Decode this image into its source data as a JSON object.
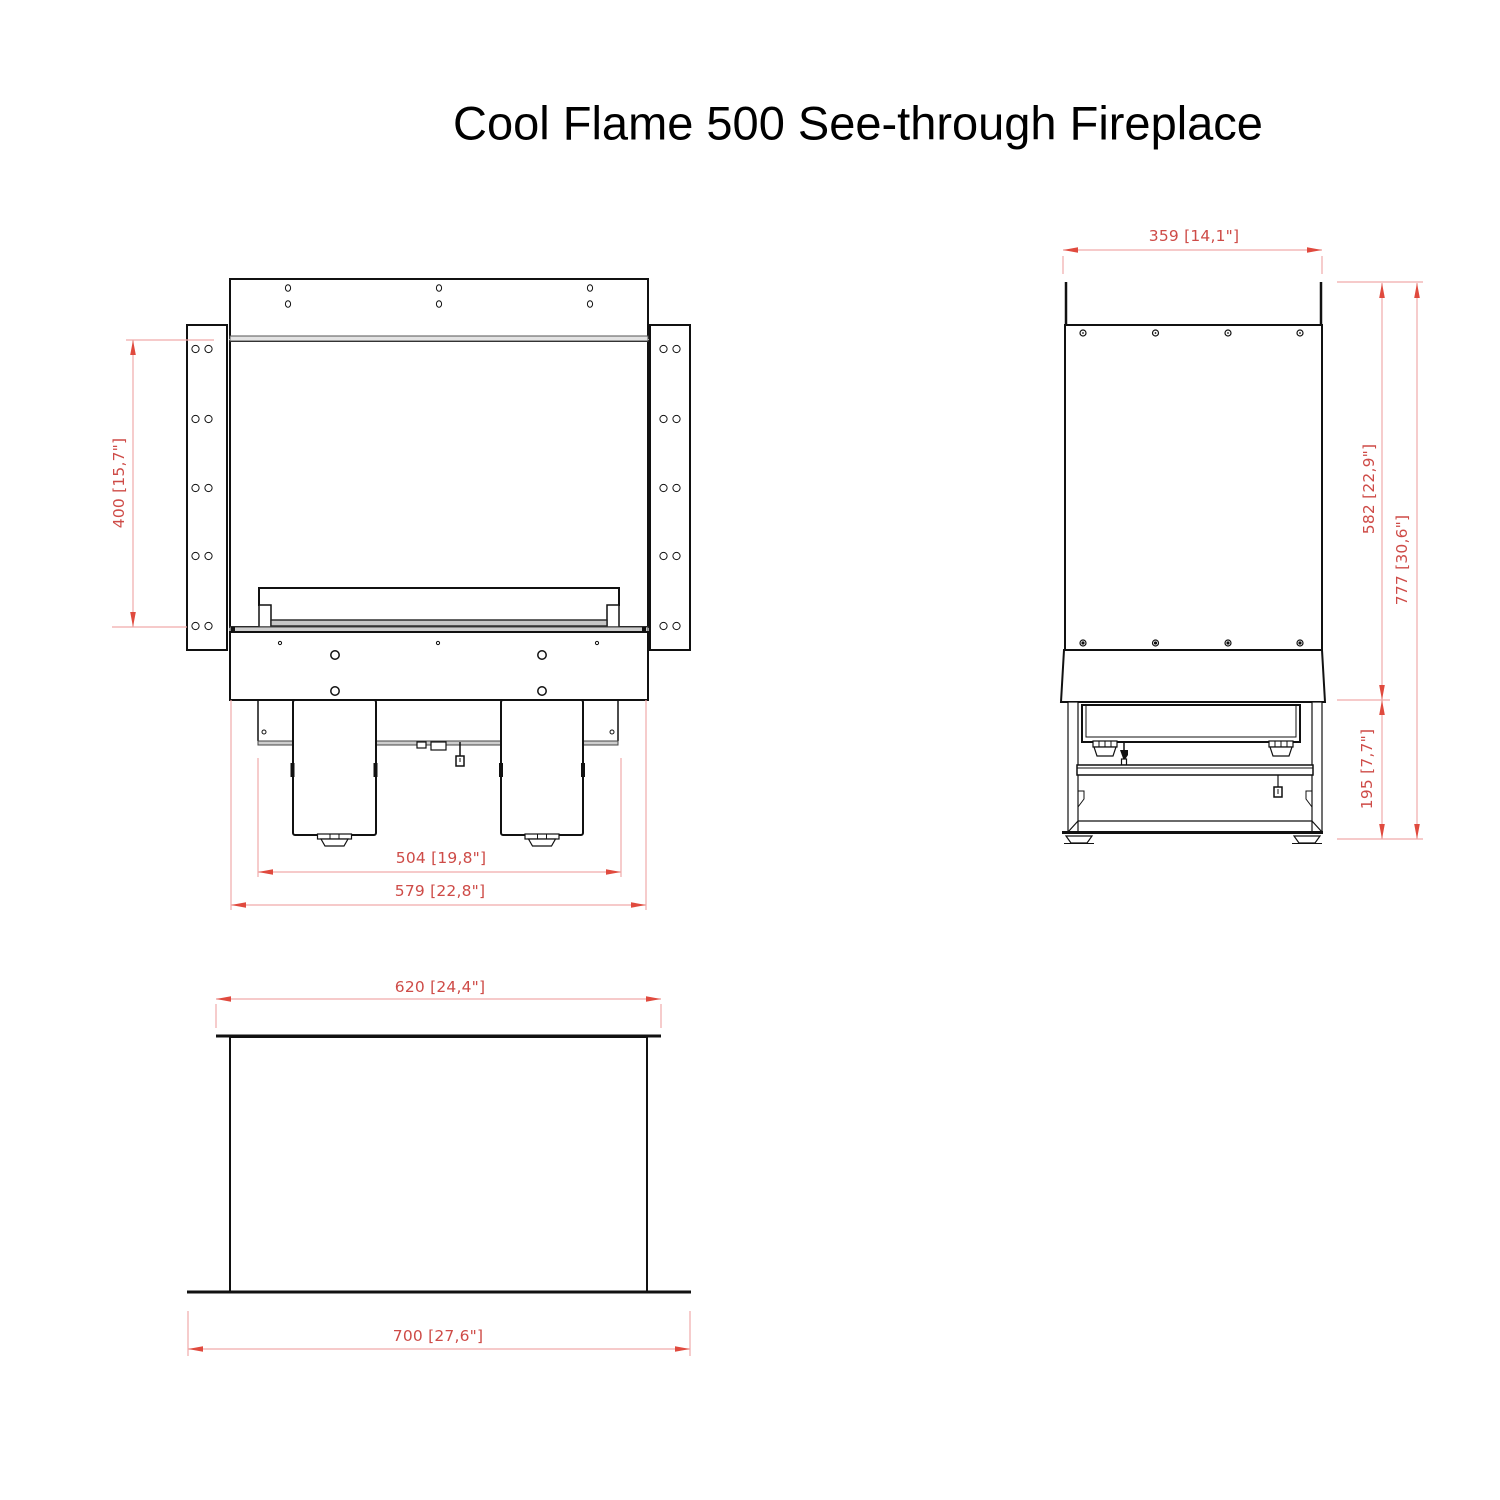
{
  "title": "Cool Flame 500 See-through Fireplace",
  "colors": {
    "drawing_line": "#111111",
    "dimension_text": "#ce4b47",
    "dimension_line": "#f0aaaa",
    "dimension_arrow": "#e04a3e"
  },
  "views": {
    "front": {
      "dim_window_height": "400 [15,7\"]",
      "dim_legs_width": "504 [19,8\"]",
      "dim_body_width": "579 [22,8\"]"
    },
    "side": {
      "dim_depth": "359 [14,1\"]",
      "dim_body_height": "582 [22,9\"]",
      "dim_total_height": "777 [30,6\"]",
      "dim_base_height": "195 [7,7\"]"
    },
    "plan": {
      "dim_opening_width": "620 [24,4\"]",
      "dim_outer_width": "700 [27,6\"]"
    }
  }
}
